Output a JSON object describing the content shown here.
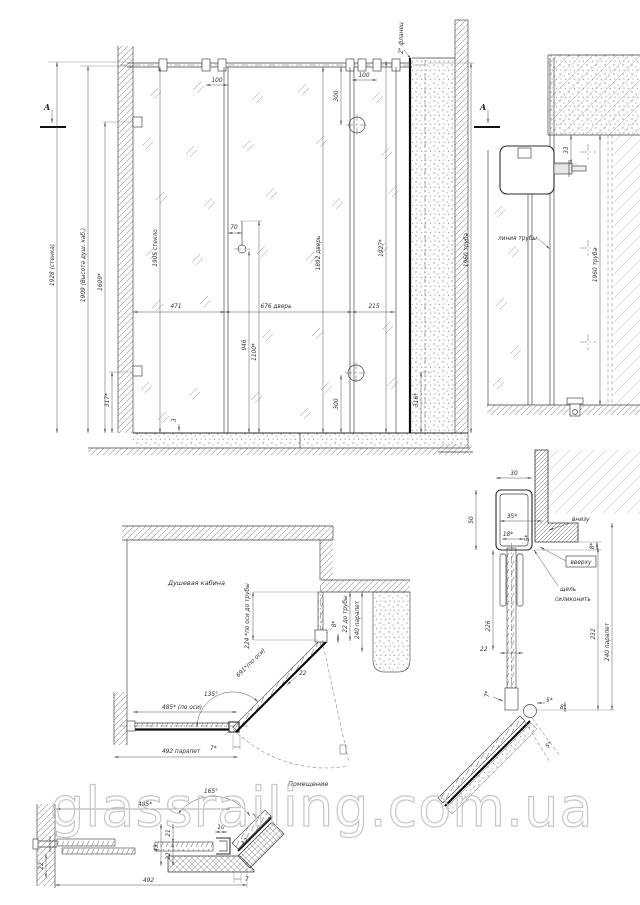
{
  "watermark": "glassrailing.com.ua",
  "elevation": {
    "section_label": "A",
    "top_note": "2\" фланец",
    "dim_wall_h": "1928 (стенка)",
    "dim_cabin_h": "1909 (Высота душ. каб.)",
    "dim_1609": "1609*",
    "dim_glass_h": "1905 стекло",
    "dim_471": "471",
    "dim_door_w": "676 дверь",
    "dim_215": "215",
    "dim_70": "70",
    "dim_946": "946",
    "dim_1100": "1100*",
    "dim_door_h": "1892 дверь",
    "dim_1927": "1927*",
    "dim_300": "300",
    "dim_100": "100",
    "dim_316": "316*",
    "dim_317": "317*",
    "dim_curb3": "3",
    "dim_pipe_h": "1960 труба"
  },
  "detail_top_right": {
    "dim_33": "33",
    "pipe_line_label": "линия трубы",
    "dim_pipe_h": "1960 труба"
  },
  "plan": {
    "room_label": "Душевая кабина",
    "outside_label": "Помещение",
    "dim_axis_pipe": "224 *по оси до трубы",
    "dim_8": "8*",
    "dim_22_pipe": "22 до трубы",
    "dim_parapet_240": "240 парапет",
    "dim_door_axis": "691*(по оси)",
    "dim_22": "22",
    "angle_135": "135°",
    "dim_fixed_axis": "485* (по оси)",
    "dim_7": "7*",
    "dim_parapet_492": "492 парапет"
  },
  "detail_profile": {
    "dim_30": "30",
    "dim_50": "50",
    "dim_35": "35*",
    "dim_18": "18*",
    "dim_5": "5*",
    "dim_8": "8*",
    "note_bottom": "внизу",
    "note_top": "вверху",
    "note_silicone_1": "щель",
    "note_silicone_2": "силиконить",
    "dim_226": "226",
    "dim_22": "22",
    "dim_7": "7*",
    "dim_8b": "8",
    "dim_232": "232",
    "dim_parapet_240": "240 парапет"
  },
  "detail_bottom": {
    "dim_485": "485*",
    "dim_492": "492",
    "angle_165": "165°",
    "dim_22_wall": "22",
    "dim_21": "21",
    "dim_43": "43",
    "dim_22b": "22",
    "dim_10": "10",
    "dim_12": "12",
    "dim_1": "1",
    "dim_7": "7"
  }
}
